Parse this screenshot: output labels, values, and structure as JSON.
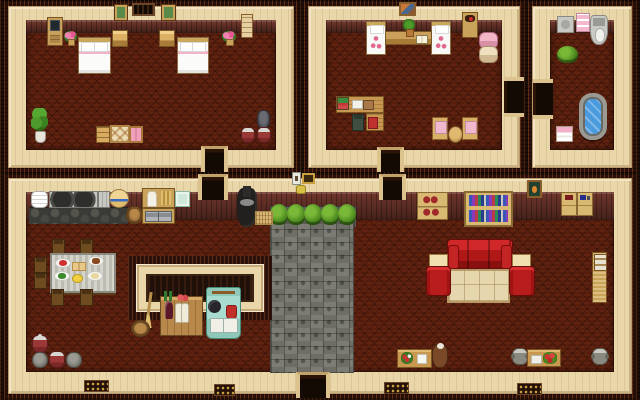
{
  "meta": {
    "title": "pixel-art farmhouse interior - top-down game view",
    "width": 640,
    "height": 400
  },
  "palette": {
    "wall_cream": "#e9d6a9",
    "trim_dark": "#2a1009",
    "wallpaper_brown": "#6d352a",
    "carpet_red": "#571e0d",
    "stone_gray": "#74746c",
    "hedge_green": "#4c8a20",
    "couch_red": "#b01818",
    "stove_teal": "#a8dcd0",
    "water_blue": "#4a9ade",
    "wood_tan": "#caa35a"
  },
  "rooms": [
    {
      "id": "room-bedroom",
      "label": "bedroom"
    },
    {
      "id": "room-study",
      "label": "study bedroom"
    },
    {
      "id": "room-bathroom",
      "label": "bathroom"
    },
    {
      "id": "room-main",
      "label": "main room with kitchen and living room"
    }
  ],
  "items": [
    {
      "t": "stone-strip",
      "n": "stone-ledge",
      "x": 270,
      "y": 206,
      "w": 86,
      "h": 21,
      "i": 0
    },
    {
      "t": "stone-path",
      "n": "stone-path",
      "x": 270,
      "y": 224,
      "w": 84,
      "h": 149,
      "i": 0
    },
    {
      "t": "cobble-dark",
      "n": "kitchen-stone-floor",
      "x": 29,
      "y": 207,
      "w": 99,
      "h": 17,
      "i": 0
    },
    {
      "t": "bush",
      "n": "hedge-1",
      "x": 270,
      "y": 204,
      "w": 18,
      "h": 21,
      "i": 0
    },
    {
      "t": "bush",
      "n": "hedge-2",
      "x": 287,
      "y": 204,
      "w": 18,
      "h": 21,
      "i": 0
    },
    {
      "t": "bush",
      "n": "hedge-3",
      "x": 304,
      "y": 204,
      "w": 18,
      "h": 21,
      "i": 0
    },
    {
      "t": "bush",
      "n": "hedge-4",
      "x": 321,
      "y": 204,
      "w": 18,
      "h": 21,
      "i": 0
    },
    {
      "t": "bush",
      "n": "hedge-5",
      "x": 338,
      "y": 204,
      "w": 18,
      "h": 21,
      "i": 0
    },
    {
      "t": "inner-trim",
      "n": "inner-room-trim",
      "x": 128,
      "y": 256,
      "w": 144,
      "h": 64,
      "i": 0
    },
    {
      "t": "inner-wall",
      "n": "inner-room-wall",
      "x": 136,
      "y": 264,
      "w": 128,
      "h": 48,
      "i": 0
    },
    {
      "t": "inner-dark",
      "n": "inner-room-interior",
      "x": 146,
      "y": 274,
      "w": 108,
      "h": 28,
      "i": 0
    },
    {
      "t": "picture-green",
      "n": "wall-picture-left",
      "x": 115,
      "y": 5,
      "w": 12,
      "h": 15,
      "i": 0
    },
    {
      "t": "window-vent",
      "n": "wall-vent-window",
      "x": 132,
      "y": 3,
      "w": 23,
      "h": 13,
      "i": 0
    },
    {
      "t": "picture-green",
      "n": "wall-picture-right",
      "x": 162,
      "y": 5,
      "w": 13,
      "h": 15,
      "i": 0
    },
    {
      "t": "desk-computer",
      "n": "computer-desk",
      "x": 47,
      "y": 17,
      "w": 16,
      "h": 29,
      "i": 1
    },
    {
      "t": "flower-pot-pink",
      "n": "flower-pot-left",
      "x": 64,
      "y": 31,
      "w": 13,
      "h": 15,
      "i": 0
    },
    {
      "t": "bed-large",
      "n": "double-bed-left",
      "x": 78,
      "y": 37,
      "w": 33,
      "h": 37,
      "i": 1
    },
    {
      "t": "nightstand",
      "n": "nightstand-left",
      "x": 112,
      "y": 30,
      "w": 16,
      "h": 17,
      "i": 1
    },
    {
      "t": "nightstand",
      "n": "nightstand-right",
      "x": 159,
      "y": 30,
      "w": 16,
      "h": 17,
      "i": 1
    },
    {
      "t": "bed-large",
      "n": "double-bed-right",
      "x": 177,
      "y": 37,
      "w": 32,
      "h": 37,
      "i": 1
    },
    {
      "t": "flower-pot-pink",
      "n": "flower-pot-right",
      "x": 222,
      "y": 31,
      "w": 14,
      "h": 15,
      "i": 0
    },
    {
      "t": "wall-scroll",
      "n": "wall-scroll",
      "x": 241,
      "y": 14,
      "w": 12,
      "h": 24,
      "i": 0
    },
    {
      "t": "plant-tall",
      "n": "potted-plant-bedroom",
      "x": 31,
      "y": 108,
      "w": 17,
      "h": 35,
      "i": 0
    },
    {
      "t": "dresser-small",
      "n": "dresser",
      "x": 96,
      "y": 126,
      "w": 14,
      "h": 17,
      "i": 1
    },
    {
      "t": "quilt-rug",
      "n": "quilt-rug",
      "x": 110,
      "y": 125,
      "w": 20,
      "h": 18,
      "i": 0
    },
    {
      "t": "futon-pink",
      "n": "pink-futon",
      "x": 129,
      "y": 126,
      "w": 14,
      "h": 17,
      "i": 0
    },
    {
      "t": "jug-dark",
      "n": "dark-jug",
      "x": 257,
      "y": 110,
      "w": 13,
      "h": 19,
      "i": 0
    },
    {
      "t": "pot-red",
      "n": "red-pot-1",
      "x": 241,
      "y": 127,
      "w": 14,
      "h": 16,
      "i": 0
    },
    {
      "t": "pot-red",
      "n": "red-pot-2",
      "x": 257,
      "y": 127,
      "w": 14,
      "h": 16,
      "i": 0
    },
    {
      "t": "door-v",
      "n": "door-bedroom-south",
      "x": 201,
      "y": 146,
      "w": 27,
      "h": 26,
      "i": 1
    },
    {
      "t": "painting",
      "n": "wall-painting-study",
      "x": 399,
      "y": 2,
      "w": 17,
      "h": 14,
      "i": 0
    },
    {
      "t": "bed-small",
      "n": "single-bed-left",
      "x": 366,
      "y": 21,
      "w": 20,
      "h": 34,
      "i": 1
    },
    {
      "t": "bed-small",
      "n": "single-bed-right",
      "x": 431,
      "y": 21,
      "w": 20,
      "h": 34,
      "i": 1
    },
    {
      "t": "table-wood",
      "n": "shelf-table",
      "x": 385,
      "y": 31,
      "w": 47,
      "h": 14,
      "i": 1
    },
    {
      "t": "potted-plant-small",
      "n": "plant-on-table",
      "x": 402,
      "y": 19,
      "w": 14,
      "h": 20,
      "i": 0
    },
    {
      "t": "book-open",
      "n": "open-book",
      "x": 416,
      "y": 35,
      "w": 12,
      "h": 9,
      "i": 0
    },
    {
      "t": "cabinet-incense",
      "n": "small-cabinet",
      "x": 462,
      "y": 12,
      "w": 16,
      "h": 26,
      "i": 1
    },
    {
      "t": "futon-roll",
      "n": "rolled-futons",
      "x": 479,
      "y": 32,
      "w": 17,
      "h": 31,
      "i": 0
    },
    {
      "t": "desk-wood",
      "n": "study-desk",
      "x": 336,
      "y": 96,
      "w": 48,
      "h": 17,
      "i": 1
    },
    {
      "t": "books-stack",
      "n": "books-on-desk",
      "x": 337,
      "y": 97,
      "w": 12,
      "h": 13,
      "i": 0
    },
    {
      "t": "papers-white",
      "n": "papers",
      "x": 352,
      "y": 100,
      "w": 11,
      "h": 9,
      "i": 0
    },
    {
      "t": "clipboard",
      "n": "clipboard",
      "x": 363,
      "y": 100,
      "w": 11,
      "h": 10,
      "i": 0
    },
    {
      "t": "desk-wood-v",
      "n": "study-desk-return",
      "x": 366,
      "y": 113,
      "w": 18,
      "h": 18,
      "i": 1
    },
    {
      "t": "chair-dark",
      "n": "desk-chair",
      "x": 352,
      "y": 114,
      "w": 12,
      "h": 17,
      "i": 1
    },
    {
      "t": "book-red",
      "n": "red-book",
      "x": 368,
      "y": 117,
      "w": 10,
      "h": 12,
      "i": 0
    },
    {
      "t": "chair-cushion",
      "n": "cushion-chair-left",
      "x": 432,
      "y": 117,
      "w": 16,
      "h": 23,
      "i": 1
    },
    {
      "t": "chair-cushion",
      "n": "cushion-chair-right",
      "x": 462,
      "y": 117,
      "w": 16,
      "h": 23,
      "i": 1
    },
    {
      "t": "table-round",
      "n": "round-table",
      "x": 448,
      "y": 126,
      "w": 15,
      "h": 17,
      "i": 1
    },
    {
      "t": "door-v",
      "n": "door-study-south",
      "x": 377,
      "y": 147,
      "w": 27,
      "h": 25,
      "i": 1
    },
    {
      "t": "door-h",
      "n": "door-study-east",
      "x": 504,
      "y": 77,
      "w": 20,
      "h": 40,
      "i": 1
    },
    {
      "t": "sink",
      "n": "bathroom-sink",
      "x": 557,
      "y": 16,
      "w": 17,
      "h": 17,
      "i": 1
    },
    {
      "t": "towel-cabinet-pink",
      "n": "towel-cabinet",
      "x": 576,
      "y": 13,
      "w": 14,
      "h": 19,
      "i": 0
    },
    {
      "t": "toilet",
      "n": "toilet",
      "x": 590,
      "y": 15,
      "w": 18,
      "h": 30,
      "i": 1
    },
    {
      "t": "bush",
      "n": "bathroom-plant",
      "x": 557,
      "y": 46,
      "w": 21,
      "h": 17,
      "i": 0
    },
    {
      "t": "bathtub",
      "n": "bathtub",
      "x": 579,
      "y": 93,
      "w": 28,
      "h": 47,
      "i": 1
    },
    {
      "t": "towel-stack",
      "n": "towel-stack",
      "x": 556,
      "y": 126,
      "w": 17,
      "h": 16,
      "i": 0
    },
    {
      "t": "door-h",
      "n": "door-bathroom-west",
      "x": 533,
      "y": 79,
      "w": 20,
      "h": 40,
      "i": 1
    },
    {
      "t": "switch-plate",
      "n": "light-switch",
      "x": 292,
      "y": 172,
      "w": 9,
      "h": 13,
      "i": 0
    },
    {
      "t": "frame-gold",
      "n": "small-gold-frame",
      "x": 302,
      "y": 173,
      "w": 13,
      "h": 11,
      "i": 0
    },
    {
      "t": "basket-yellow",
      "n": "small-yellow-basket",
      "x": 296,
      "y": 185,
      "w": 10,
      "h": 9,
      "i": 0
    },
    {
      "t": "door-v",
      "n": "door-main-northwest",
      "x": 198,
      "y": 174,
      "w": 30,
      "h": 26,
      "i": 1
    },
    {
      "t": "door-v",
      "n": "door-main-north",
      "x": 379,
      "y": 174,
      "w": 27,
      "h": 26,
      "i": 1
    },
    {
      "t": "door-v",
      "n": "door-main-south",
      "x": 296,
      "y": 372,
      "w": 34,
      "h": 26,
      "i": 1
    },
    {
      "t": "plates-stack",
      "n": "plate-stack",
      "x": 31,
      "y": 191,
      "w": 17,
      "h": 17,
      "i": 0
    },
    {
      "t": "stove-metal",
      "n": "kitchen-stove",
      "x": 49,
      "y": 191,
      "w": 49,
      "h": 17,
      "i": 1
    },
    {
      "t": "counter-metal",
      "n": "metal-counter",
      "x": 98,
      "y": 191,
      "w": 12,
      "h": 17,
      "i": 0
    },
    {
      "t": "basin-hat",
      "n": "straw-hat-basin",
      "x": 109,
      "y": 189,
      "w": 20,
      "h": 19,
      "i": 0
    },
    {
      "t": "barrel",
      "n": "barrel",
      "x": 126,
      "y": 206,
      "w": 17,
      "h": 18,
      "i": 1
    },
    {
      "t": "cabinet-kitchen-top",
      "n": "kitchen-cabinet",
      "x": 142,
      "y": 188,
      "w": 33,
      "h": 20,
      "i": 1
    },
    {
      "t": "cabinet-kitchen-drawers",
      "n": "kitchen-drawers",
      "x": 142,
      "y": 208,
      "w": 33,
      "h": 16,
      "i": 1
    },
    {
      "t": "tile-green",
      "n": "green-tile",
      "x": 175,
      "y": 191,
      "w": 15,
      "h": 16,
      "i": 0
    },
    {
      "t": "chair-wood",
      "n": "dining-chair-top-1",
      "x": 52,
      "y": 239,
      "w": 13,
      "h": 16,
      "i": 1
    },
    {
      "t": "chair-wood",
      "n": "dining-chair-top-2",
      "x": 80,
      "y": 239,
      "w": 13,
      "h": 16,
      "i": 1
    },
    {
      "t": "chair-wood",
      "n": "dining-chair-left-1",
      "x": 34,
      "y": 257,
      "w": 13,
      "h": 16,
      "i": 1
    },
    {
      "t": "chair-wood",
      "n": "dining-chair-left-2",
      "x": 34,
      "y": 273,
      "w": 13,
      "h": 16,
      "i": 1
    },
    {
      "t": "chair-wood",
      "n": "dining-chair-right-1",
      "x": 100,
      "y": 257,
      "w": 13,
      "h": 16,
      "i": 1
    },
    {
      "t": "chair-wood",
      "n": "dining-chair-right-2",
      "x": 100,
      "y": 273,
      "w": 13,
      "h": 16,
      "i": 1
    },
    {
      "t": "dining-table",
      "n": "dining-table",
      "x": 50,
      "y": 253,
      "w": 66,
      "h": 40,
      "i": 1
    },
    {
      "t": "chair-wood",
      "n": "dining-chair-bottom-1",
      "x": 51,
      "y": 289,
      "w": 13,
      "h": 17,
      "i": 1
    },
    {
      "t": "chair-wood",
      "n": "dining-chair-bottom-2",
      "x": 80,
      "y": 289,
      "w": 13,
      "h": 17,
      "i": 1
    },
    {
      "t": "plate-tomato",
      "n": "plate-tomatoes",
      "x": 55,
      "y": 258,
      "w": 16,
      "h": 10,
      "i": 0
    },
    {
      "t": "plate-bread",
      "n": "bread-board",
      "x": 72,
      "y": 262,
      "w": 14,
      "h": 9,
      "i": 0
    },
    {
      "t": "plate-meat",
      "n": "plate-roast",
      "x": 88,
      "y": 256,
      "w": 16,
      "h": 10,
      "i": 0
    },
    {
      "t": "plate-salad",
      "n": "plate-salad",
      "x": 54,
      "y": 271,
      "w": 16,
      "h": 10,
      "i": 0
    },
    {
      "t": "bowl-lemon",
      "n": "lemon-bowl",
      "x": 72,
      "y": 274,
      "w": 11,
      "h": 9,
      "i": 0
    },
    {
      "t": "plate-pie",
      "n": "plate-pie",
      "x": 87,
      "y": 271,
      "w": 16,
      "h": 10,
      "i": 0
    },
    {
      "t": "pot-red-lid",
      "n": "red-lidded-pot",
      "x": 32,
      "y": 335,
      "w": 16,
      "h": 18,
      "i": 0
    },
    {
      "t": "jug-gray",
      "n": "gray-jug-1",
      "x": 32,
      "y": 352,
      "w": 16,
      "h": 16,
      "i": 0
    },
    {
      "t": "pot-red",
      "n": "red-pot-kitchen",
      "x": 49,
      "y": 351,
      "w": 16,
      "h": 17,
      "i": 0
    },
    {
      "t": "jug-gray",
      "n": "gray-jug-2",
      "x": 66,
      "y": 352,
      "w": 16,
      "h": 16,
      "i": 0
    },
    {
      "t": "stove-potbelly",
      "n": "wood-stove",
      "x": 237,
      "y": 188,
      "w": 20,
      "h": 39,
      "i": 1
    },
    {
      "t": "doormat",
      "n": "doormat",
      "x": 255,
      "y": 211,
      "w": 18,
      "h": 14,
      "i": 0
    },
    {
      "t": "broom",
      "n": "broom",
      "x": 142,
      "y": 292,
      "w": 12,
      "h": 36,
      "i": 0
    },
    {
      "t": "basket",
      "n": "round-basket",
      "x": 131,
      "y": 320,
      "w": 19,
      "h": 17,
      "i": 0
    },
    {
      "t": "bar-cabinet",
      "n": "bar-cabinet",
      "x": 160,
      "y": 296,
      "w": 43,
      "h": 40,
      "i": 1
    },
    {
      "t": "bottles-green",
      "n": "green-bottles",
      "x": 162,
      "y": 291,
      "w": 12,
      "h": 10,
      "i": 0
    },
    {
      "t": "meat-red",
      "n": "hanging-meat",
      "x": 176,
      "y": 293,
      "w": 13,
      "h": 10,
      "i": 0
    },
    {
      "t": "wine-bottle",
      "n": "wine-bottle",
      "x": 165,
      "y": 301,
      "w": 8,
      "h": 18,
      "i": 0
    },
    {
      "t": "sack-white",
      "n": "flour-sacks",
      "x": 175,
      "y": 303,
      "w": 14,
      "h": 18,
      "i": 0
    },
    {
      "t": "stove-teal",
      "n": "antique-stove",
      "x": 206,
      "y": 287,
      "w": 35,
      "h": 52,
      "i": 1
    },
    {
      "t": "pan-black",
      "n": "frying-pan",
      "x": 208,
      "y": 300,
      "w": 13,
      "h": 13,
      "i": 0
    },
    {
      "t": "kettle-red",
      "n": "red-kettle",
      "x": 226,
      "y": 305,
      "w": 11,
      "h": 14,
      "i": 0
    },
    {
      "t": "drawers-white",
      "n": "stove-drawers",
      "x": 210,
      "y": 318,
      "w": 28,
      "h": 13,
      "i": 0
    },
    {
      "t": "shelf-red-jars",
      "n": "jar-shelf",
      "x": 417,
      "y": 192,
      "w": 31,
      "h": 28,
      "i": 1
    },
    {
      "t": "bookshelf",
      "n": "bookshelf",
      "x": 464,
      "y": 191,
      "w": 49,
      "h": 36,
      "i": 1
    },
    {
      "t": "picture-cat",
      "n": "cat-portrait",
      "x": 527,
      "y": 180,
      "w": 15,
      "h": 18,
      "i": 0
    },
    {
      "t": "desk-items-red",
      "n": "side-desk-red",
      "x": 561,
      "y": 192,
      "w": 16,
      "h": 24,
      "i": 1
    },
    {
      "t": "desk-items-blue",
      "n": "side-desk-blue",
      "x": 577,
      "y": 192,
      "w": 16,
      "h": 24,
      "i": 1
    },
    {
      "t": "couch-red",
      "n": "red-couch",
      "x": 447,
      "y": 239,
      "w": 66,
      "h": 30,
      "i": 1
    },
    {
      "t": "end-table",
      "n": "end-table-left",
      "x": 429,
      "y": 254,
      "w": 19,
      "h": 20,
      "i": 1
    },
    {
      "t": "end-table",
      "n": "end-table-right",
      "x": 512,
      "y": 254,
      "w": 19,
      "h": 20,
      "i": 1
    },
    {
      "t": "rug-cream",
      "n": "living-room-rug",
      "x": 447,
      "y": 269,
      "w": 63,
      "h": 34,
      "i": 0
    },
    {
      "t": "armchair-red",
      "n": "armchair-left",
      "x": 426,
      "y": 266,
      "w": 25,
      "h": 30,
      "i": 1
    },
    {
      "t": "armchair-red",
      "n": "armchair-right",
      "x": 509,
      "y": 266,
      "w": 26,
      "h": 30,
      "i": 1
    },
    {
      "t": "cabinet-tall",
      "n": "tall-cabinet",
      "x": 592,
      "y": 252,
      "w": 15,
      "h": 51,
      "i": 1
    },
    {
      "t": "side-table-flowers",
      "n": "flower-table",
      "x": 397,
      "y": 349,
      "w": 35,
      "h": 19,
      "i": 1
    },
    {
      "t": "teapot",
      "n": "teapot-jar",
      "x": 432,
      "y": 344,
      "w": 16,
      "h": 24,
      "i": 0
    },
    {
      "t": "pot-gray",
      "n": "gray-pot-1",
      "x": 512,
      "y": 348,
      "w": 16,
      "h": 17,
      "i": 0
    },
    {
      "t": "side-table-berries",
      "n": "berry-table",
      "x": 527,
      "y": 349,
      "w": 34,
      "h": 18,
      "i": 1
    },
    {
      "t": "pot-gray",
      "n": "gray-pot-2",
      "x": 592,
      "y": 348,
      "w": 16,
      "h": 17,
      "i": 0
    },
    {
      "t": "vent-gold",
      "n": "floor-vent-1",
      "x": 84,
      "y": 380,
      "w": 25,
      "h": 12,
      "i": 0
    },
    {
      "t": "vent-gold",
      "n": "floor-vent-2",
      "x": 214,
      "y": 384,
      "w": 21,
      "h": 12,
      "i": 0
    },
    {
      "t": "vent-gold",
      "n": "floor-vent-3",
      "x": 384,
      "y": 382,
      "w": 25,
      "h": 12,
      "i": 0
    },
    {
      "t": "vent-gold",
      "n": "floor-vent-4",
      "x": 517,
      "y": 383,
      "w": 25,
      "h": 12,
      "i": 0
    }
  ]
}
